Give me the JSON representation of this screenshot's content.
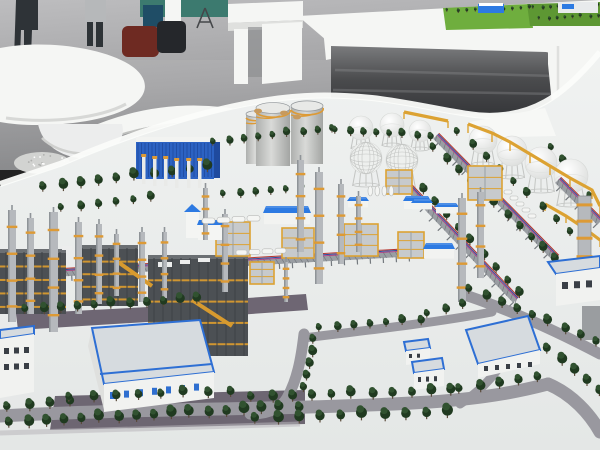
{
  "meta": {
    "description": "Photograph of a physical scale model of a petrochemical refinery complex on a white base, displayed in an exhibition hall with grey reflective flooring, white curved display furniture, a white display table carrying a small green plant model, and two visitors at the top left."
  },
  "palette": {
    "floorLight": "#bdbdbf",
    "floorMid": "#a2a2a4",
    "floorDark": "#87888a",
    "furnWhite": "#f5f6f4",
    "furnShade": "#dfe0de",
    "furnDeep": "#c7c8c6",
    "under1": "#7a7b7d",
    "under2": "#4a4b4d",
    "under3": "#36373a",
    "teal": "#3c7a6f",
    "binBlue": "#1f4d66",
    "person": "#2e3337",
    "person2": "#b6b8ba",
    "bagRed": "#6e2a22",
    "bagDark": "#25272b",
    "modelBase1": "#f0f2f1",
    "modelBase2": "#e4e7e6",
    "rimWhite": "#fbfcfa",
    "road": "#99989f",
    "parkDark": "#635a68",
    "roadLine": "#bab7bf",
    "treeA": "#203a20",
    "treeB": "#315230",
    "trunk": "#5a4a3a",
    "colSilver": "#b6b9bd",
    "colShade": "#8f9498",
    "ringOrange": "#dd9a35",
    "steelDark": "#4c5054",
    "steelMid": "#6b6f73",
    "bandYellow": "#d79a2f",
    "blueFacade": "#2c62c2",
    "blueFacadeDark": "#1f4a9e",
    "blueRoof": "#2d7ae2",
    "blueRoofLight": "#5f9ae8",
    "blueTrim": "#2e6fd4",
    "cyl1": "#aeb0ae",
    "cyl2": "#d9dad8",
    "cyl3": "#a3a5a3",
    "cylTop": "#e8e9e7",
    "sphereHi": "#ffffff",
    "sphereLo": "#d7d9d7",
    "lattice": "#c3c5c3",
    "rackGray": "#8e9398",
    "rackDark": "#74797e",
    "rackWhite": "#ececec",
    "pipeRed": "#b5342c",
    "pipeBlue": "#2c4d9b",
    "pipeMag": "#ad3a80",
    "whWall": "#f1f2f0",
    "whRoof": "#d6dbdf",
    "whWin": "#2f6fd0",
    "winDark": "#3a3f46",
    "grass": "#6fae3e",
    "grassDark": "#5d9733",
    "bridgeY": "#dca232",
    "ymodFill": "#c7cacc",
    "sparkle": "#d2d3d1",
    "tanItem": "#c79a5e",
    "graySlab": "#9a9da0"
  },
  "scene": {
    "trees": [
      [
        44,
        192,
        208,
        172,
        10,
        8
      ],
      [
        214,
        146,
        332,
        132,
        9,
        6
      ],
      [
        336,
        134,
        430,
        140,
        8,
        6
      ],
      [
        434,
        152,
        556,
        264,
        11,
        7
      ],
      [
        410,
        180,
        520,
        298,
        10,
        7
      ],
      [
        458,
        136,
        584,
        248,
        10,
        6.5
      ],
      [
        552,
        152,
        590,
        200,
        5,
        6.5
      ],
      [
        26,
        314,
        198,
        304,
        11,
        7.5
      ],
      [
        8,
        412,
        70,
        406,
        4,
        8
      ],
      [
        10,
        428,
        298,
        412,
        17,
        8.5
      ],
      [
        70,
        402,
        230,
        396,
        8,
        7.5
      ],
      [
        252,
        402,
        452,
        396,
        11,
        8
      ],
      [
        256,
        424,
        448,
        418,
        10,
        9
      ],
      [
        460,
        394,
        538,
        382,
        5,
        8
      ],
      [
        470,
        294,
        596,
        346,
        9,
        7.5
      ],
      [
        548,
        354,
        600,
        396,
        5,
        8.5
      ],
      [
        314,
        344,
        304,
        392,
        5,
        7.5
      ],
      [
        224,
        198,
        302,
        192,
        6,
        6
      ],
      [
        62,
        212,
        152,
        202,
        6,
        6.5
      ],
      [
        320,
        332,
        420,
        324,
        7,
        6.5
      ],
      [
        428,
        318,
        462,
        308,
        3,
        6.5
      ]
    ],
    "mini_tree_rows": [
      [
        448,
        12,
        530,
        9,
        10,
        2.6
      ],
      [
        534,
        9,
        598,
        6,
        9,
        2.6
      ],
      [
        540,
        20,
        598,
        17,
        8,
        2.6
      ]
    ],
    "columns": [
      [
        8,
        322,
        112,
        8
      ],
      [
        27,
        314,
        96,
        7
      ],
      [
        49,
        332,
        120,
        9
      ],
      [
        75,
        314,
        92,
        7
      ],
      [
        96,
        304,
        80,
        6
      ],
      [
        114,
        296,
        62,
        5
      ],
      [
        139,
        302,
        70,
        6
      ],
      [
        162,
        298,
        66,
        5
      ],
      [
        203,
        240,
        52,
        5
      ],
      [
        222,
        292,
        78,
        6
      ],
      [
        297,
        252,
        92,
        7
      ],
      [
        315,
        284,
        112,
        8
      ],
      [
        338,
        264,
        80,
        6
      ],
      [
        356,
        252,
        56,
        5
      ],
      [
        458,
        302,
        104,
        8
      ],
      [
        477,
        278,
        86,
        7
      ],
      [
        284,
        302,
        40,
        4
      ]
    ],
    "mini_columns": [
      [
        142,
        184
      ],
      [
        153,
        186
      ],
      [
        164,
        186
      ],
      [
        175,
        188
      ],
      [
        187,
        188
      ],
      [
        198,
        188
      ]
    ],
    "chimney": {
      "x": 578,
      "y": 196,
      "w": 13,
      "h": 74
    },
    "cylinders": [
      [
        246,
        114,
        20,
        50
      ],
      [
        256,
        108,
        34,
        58
      ],
      [
        291,
        106,
        32,
        58
      ]
    ],
    "spheres": [
      [
        361,
        128,
        12,
        9,
        0
      ],
      [
        392,
        125,
        12,
        9,
        0
      ],
      [
        420,
        131,
        11,
        8,
        0
      ],
      [
        366,
        158,
        16,
        12,
        1
      ],
      [
        402,
        160,
        16,
        12,
        1
      ],
      [
        483,
        140,
        14,
        11,
        0
      ],
      [
        512,
        151,
        15,
        12,
        0
      ],
      [
        541,
        163,
        16,
        13,
        0
      ],
      [
        571,
        176,
        17,
        13,
        0
      ]
    ],
    "racks": [
      [
        436,
        136,
        556,
        258
      ],
      [
        404,
        182,
        516,
        300
      ],
      [
        558,
        180,
        600,
        222
      ],
      [
        0,
        276,
        418,
        252
      ],
      [
        216,
        262,
        224,
        332
      ]
    ],
    "steel_modules": [
      [
        0,
        252,
        66,
        62
      ],
      [
        76,
        248,
        62,
        58
      ],
      [
        148,
        258,
        100,
        98
      ]
    ],
    "deck_items": [
      [
        158,
        262,
        14,
        5
      ],
      [
        180,
        260,
        10,
        4
      ],
      [
        198,
        258,
        12,
        4
      ],
      [
        62,
        246,
        10,
        4
      ]
    ],
    "crane_arms": [
      [
        118,
        262,
        152,
        286
      ],
      [
        192,
        300,
        232,
        326
      ]
    ],
    "yellow_modules": [
      [
        216,
        222,
        34,
        34
      ],
      [
        282,
        228,
        32,
        30
      ],
      [
        344,
        224,
        34,
        32
      ],
      [
        386,
        170,
        26,
        24
      ],
      [
        468,
        166,
        34,
        34
      ],
      [
        398,
        232,
        26,
        26
      ],
      [
        250,
        262,
        24,
        22
      ]
    ],
    "gable_buildings": [
      [
        264,
        206,
        46,
        7
      ],
      [
        404,
        196,
        26,
        5
      ],
      [
        348,
        197,
        20,
        4
      ],
      [
        412,
        199,
        20,
        4
      ],
      [
        436,
        203,
        22,
        4
      ],
      [
        424,
        243,
        30,
        6
      ]
    ],
    "church": {
      "tower": [
        186,
        210,
        13,
        28
      ],
      "body": [
        198,
        224,
        24,
        16
      ]
    },
    "flat_buildings": [
      {
        "roof": [
          [
            92,
            328
          ],
          [
            200,
            320
          ],
          [
            214,
            372
          ],
          [
            104,
            384
          ]
        ],
        "wall": [
          [
            104,
            384
          ],
          [
            214,
            372
          ],
          [
            214,
            398
          ],
          [
            104,
            412
          ]
        ],
        "side": [
          [
            92,
            328
          ],
          [
            104,
            384
          ],
          [
            104,
            410
          ],
          [
            88,
            346
          ]
        ],
        "wins": [
          110,
          392,
          7,
          14,
          5,
          7,
          -1.4
        ],
        "win": "blue",
        "step": [
          [
            100,
            374
          ],
          [
            212,
            364
          ]
        ]
      },
      {
        "roof": [
          [
            0,
            330
          ],
          [
            34,
            326
          ],
          [
            34,
            334
          ],
          [
            0,
            339
          ]
        ],
        "wall": [
          [
            0,
            339
          ],
          [
            34,
            334
          ],
          [
            34,
            392
          ],
          [
            0,
            398
          ]
        ],
        "wins": [
          4,
          348,
          3,
          10,
          5,
          6,
          -0.5
        ],
        "win": "dark",
        "wins2": [
          4,
          364,
          3,
          10,
          5,
          6,
          -0.5
        ]
      },
      {
        "roof": [
          [
            466,
            330
          ],
          [
            528,
            316
          ],
          [
            540,
            350
          ],
          [
            478,
            364
          ]
        ],
        "wall": [
          [
            478,
            364
          ],
          [
            540,
            350
          ],
          [
            540,
            364
          ],
          [
            478,
            378
          ]
        ],
        "wins": [
          484,
          366,
          5,
          11,
          4,
          5,
          -1.0
        ],
        "win": "dark"
      },
      {
        "roof": [
          [
            404,
            342
          ],
          [
            428,
            339
          ],
          [
            430,
            348
          ],
          [
            406,
            351
          ]
        ],
        "wall": [
          [
            406,
            351
          ],
          [
            430,
            348
          ],
          [
            430,
            362
          ],
          [
            406,
            365
          ]
        ],
        "wins": [
          409,
          354,
          2,
          8,
          3,
          4,
          -0.3
        ],
        "win": "dark"
      },
      {
        "roof": [
          [
            412,
            362
          ],
          [
            442,
            358
          ],
          [
            444,
            369
          ],
          [
            414,
            373
          ]
        ],
        "wall": [
          [
            414,
            373
          ],
          [
            444,
            369
          ],
          [
            444,
            386
          ],
          [
            414,
            390
          ]
        ],
        "wins": [
          418,
          377,
          3,
          8,
          3,
          5,
          -0.4
        ],
        "win": "dark"
      },
      {
        "roof": [
          [
            548,
            262
          ],
          [
            600,
            256
          ],
          [
            600,
            268
          ],
          [
            556,
            274
          ]
        ],
        "wall": [
          [
            556,
            274
          ],
          [
            600,
            268
          ],
          [
            600,
            300
          ],
          [
            556,
            306
          ]
        ],
        "wins": [
          562,
          282,
          3,
          12,
          6,
          7,
          -0.8
        ],
        "win": "dark"
      }
    ],
    "tank_rows": [
      {
        "x": 202,
        "y": 218,
        "n": 4,
        "dx": 15,
        "dy": -0.8,
        "w": 13,
        "h": 5.5
      },
      {
        "x": 236,
        "y": 250,
        "n": 4,
        "dx": 13,
        "dy": -0.6,
        "w": 11,
        "h": 5
      },
      {
        "x": 504,
        "y": 190,
        "n": 5,
        "dx": 6,
        "dy": 6,
        "w": 8,
        "h": 4
      },
      {
        "x": 368,
        "y": 186,
        "n": 4,
        "dx": 7,
        "dy": 0,
        "w": 4.5,
        "h": 10
      }
    ],
    "bridges": [
      {
        "pts": [
          [
            468,
            124
          ],
          [
            492,
            133
          ],
          [
            510,
            142
          ],
          [
            530,
            154
          ],
          [
            550,
            166
          ],
          [
            570,
            178
          ],
          [
            592,
            190
          ],
          [
            600,
            206
          ]
        ],
        "post": 9
      },
      {
        "pts": [
          [
            404,
            112
          ],
          [
            448,
            121
          ]
        ],
        "post": 7
      },
      {
        "pts": [
          [
            545,
            204
          ],
          [
            566,
            216
          ],
          [
            584,
            228
          ],
          [
            600,
            240
          ]
        ],
        "post": 7
      }
    ],
    "roads": [
      {
        "d": "M0,416 C140,408 300,410 430,402 C490,398 525,390 548,384",
        "w": 13
      },
      {
        "d": "M548,384 C572,394 590,414 600,432",
        "w": 13
      },
      {
        "d": "M304,334 C301,360 297,380 287,398 C280,410 266,414 250,414",
        "w": 11
      },
      {
        "d": "M303,338 C370,330 440,322 492,312",
        "w": 9
      },
      {
        "d": "M468,296 C515,312 562,334 600,354",
        "w": 11
      },
      {
        "d": "M460,404 C492,384 510,356 516,330",
        "w": 9
      }
    ],
    "road_fills": [
      [
        [
          55,
          396
        ],
        [
          305,
          390
        ],
        [
          305,
          424
        ],
        [
          50,
          430
        ]
      ],
      [
        [
          16,
          314
        ],
        [
          206,
          304
        ],
        [
          210,
          318
        ],
        [
          18,
          330
        ]
      ],
      [
        [
          218,
          300
        ],
        [
          306,
          294
        ],
        [
          308,
          310
        ],
        [
          222,
          316
        ]
      ]
    ],
    "speckles": {
      "cx": 42,
      "cy": 163,
      "rx": 28,
      "ry": 11,
      "n": 16
    },
    "rim_items": [
      [
        258,
        111
      ],
      [
        284,
        113
      ],
      [
        297,
        117
      ]
    ],
    "ribs": {
      "x": 136,
      "y": 143,
      "w": 78,
      "h": 34,
      "step": 3.5
    }
  }
}
